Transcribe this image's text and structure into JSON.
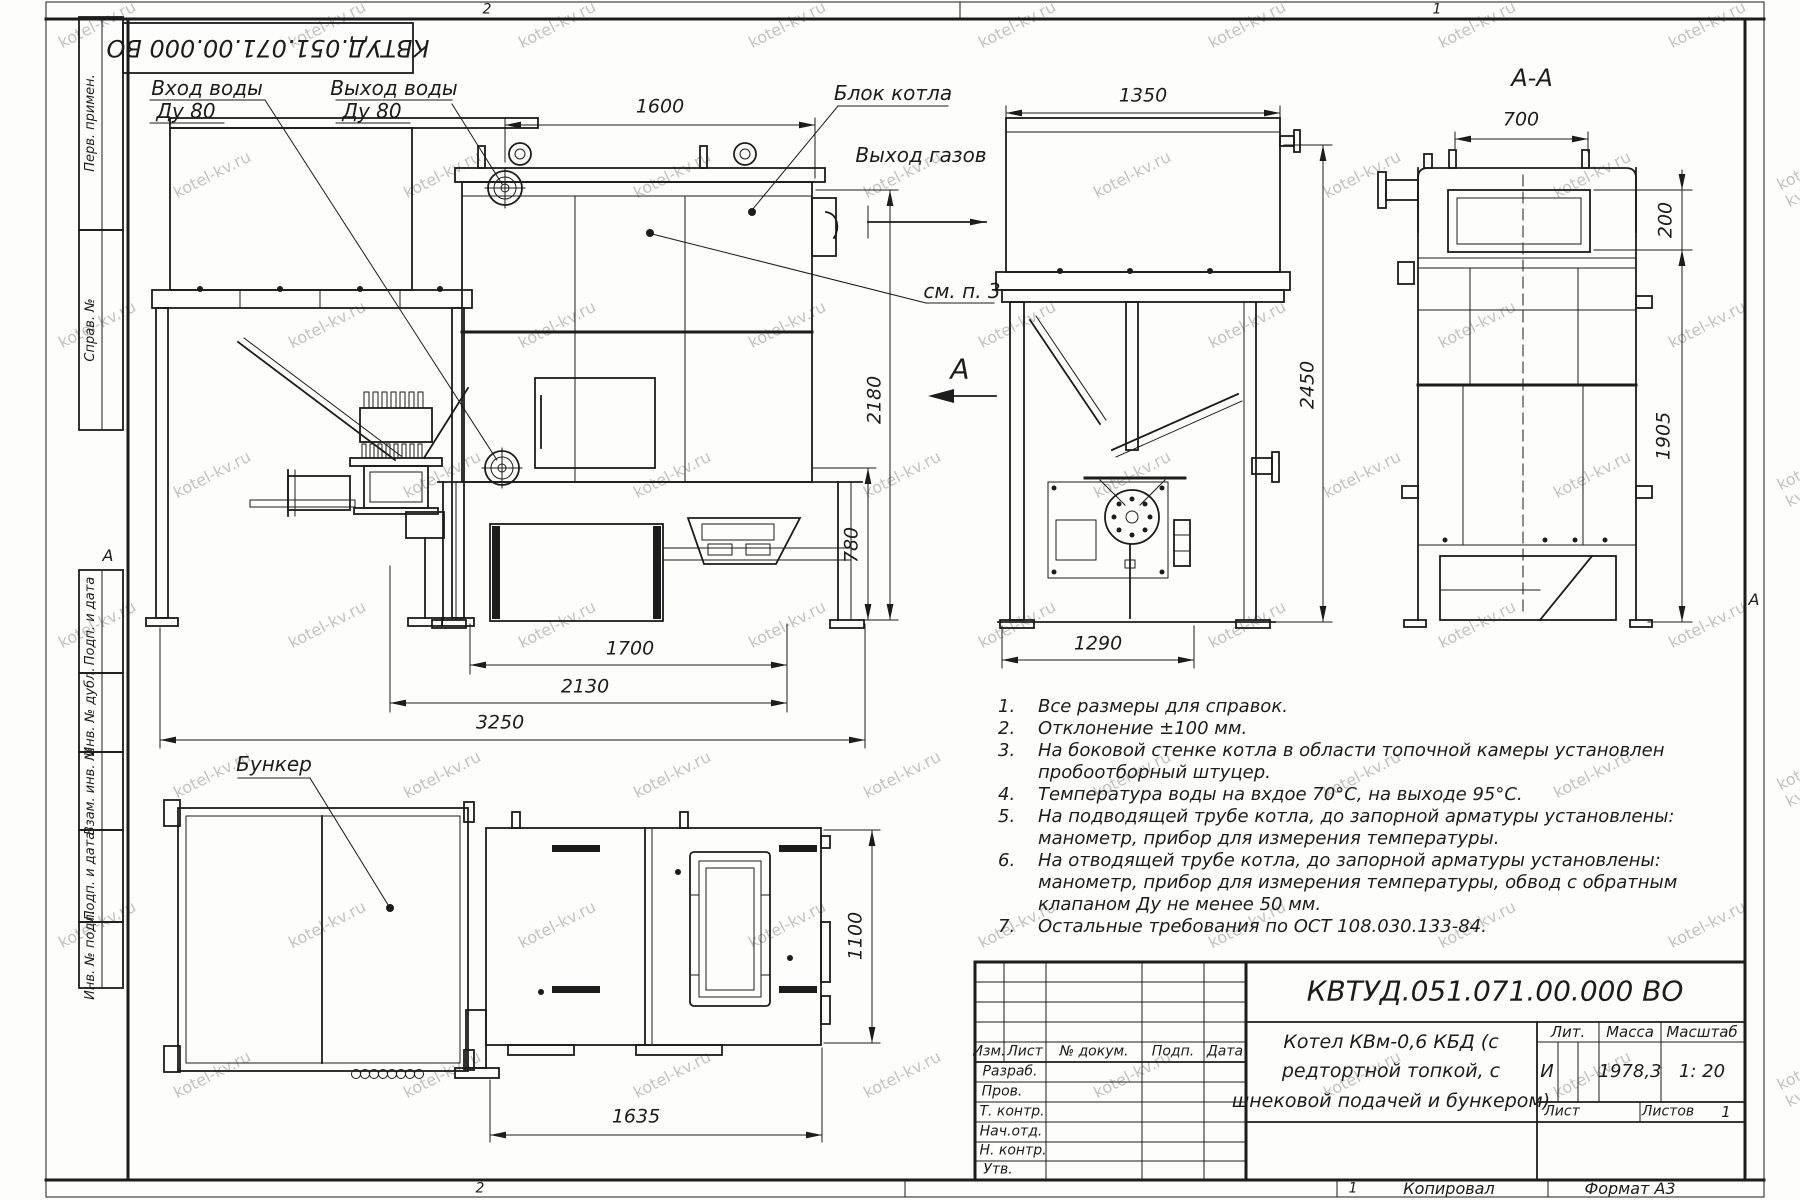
{
  "sheet": {
    "watermark": "kotel-kv.ru",
    "stamp_code": "КВТУД.051.071.00.000 ВО",
    "zone_top_left": "2",
    "zone_top_right": "1",
    "zone_bottom_left": "2",
    "zone_bottom_right": "1",
    "copied": "Копировал",
    "format": "Формат А3",
    "margin_marker": "А"
  },
  "sidebar": {
    "items": [
      "Перв. примен.",
      "Справ. №",
      "Подп. и дата",
      "Инв. № дубл.",
      "Взам. инв. №",
      "Подп. и дата",
      "Инв. № подл."
    ]
  },
  "views": {
    "side": {
      "labels": {
        "inlet": "Вход воды",
        "inlet_dn": "Ду 80",
        "outlet": "Выход воды",
        "outlet_dn": "Ду 80"
      }
    },
    "front": {
      "labels": {
        "block": "Блок котла",
        "gas": "Выход газов",
        "see_note": "см. п. 3",
        "section_letter": "А"
      },
      "dims": {
        "width": "1600",
        "height": "2180",
        "ash": "780",
        "len1": "1700",
        "len2": "2130",
        "len3": "3250"
      }
    },
    "rear": {
      "dims": {
        "width": "1350",
        "height": "2450",
        "base": "1290"
      }
    },
    "section": {
      "title": "А-А",
      "dims": {
        "width": "700",
        "flue": "200",
        "height": "1905"
      }
    },
    "plan": {
      "bunker_label": "Бункер",
      "dims": {
        "length": "1635",
        "width": "1100"
      }
    }
  },
  "notes": [
    {
      "n": "1.",
      "text": "Все размеры для справок."
    },
    {
      "n": "2.",
      "text": "Отклонение ±100 мм."
    },
    {
      "n": "3.",
      "text": "На боковой стенке котла в области топочной камеры установлен\nпробоотборный штуцер."
    },
    {
      "n": "4.",
      "text": "Температура воды на вхдое 70°С, на выходе 95°С."
    },
    {
      "n": "5.",
      "text": "На подводящей трубе котла, до запорной арматуры установлены:\nманометр, прибор для измерения температуры."
    },
    {
      "n": "6.",
      "text": "На отводящей трубе котла, до запорной арматуры установлены:\nманометр, прибор для измерения температуры, обвод с обратным\nклапаном Ду не менее 50 мм."
    },
    {
      "n": "7.",
      "text": "Остальные требования по ОСТ 108.030.133-84."
    }
  ],
  "title_block": {
    "code": "КВТУД.051.071.00.000 ВО",
    "name": "Котел КВм-0,6 КБД (с\nредтортной топкой, с\nшнековой подачей и бункером)",
    "col_izm": "Изм.",
    "col_list": "Лист",
    "col_doc": "№ докум.",
    "col_sign": "Подп.",
    "col_date": "Дата",
    "rows": [
      "Разраб.",
      "Пров.",
      "Т. контр.",
      "Нач.отд.",
      "Н. контр.",
      "Утв."
    ],
    "lit_h": "Лит.",
    "mass_h": "Масса",
    "scale_h": "Масштаб",
    "lit": "И",
    "mass": "1978,3",
    "scale": "1: 20",
    "sheet_h": "Лист",
    "sheets_h": "Листов",
    "sheets_val": "1"
  }
}
